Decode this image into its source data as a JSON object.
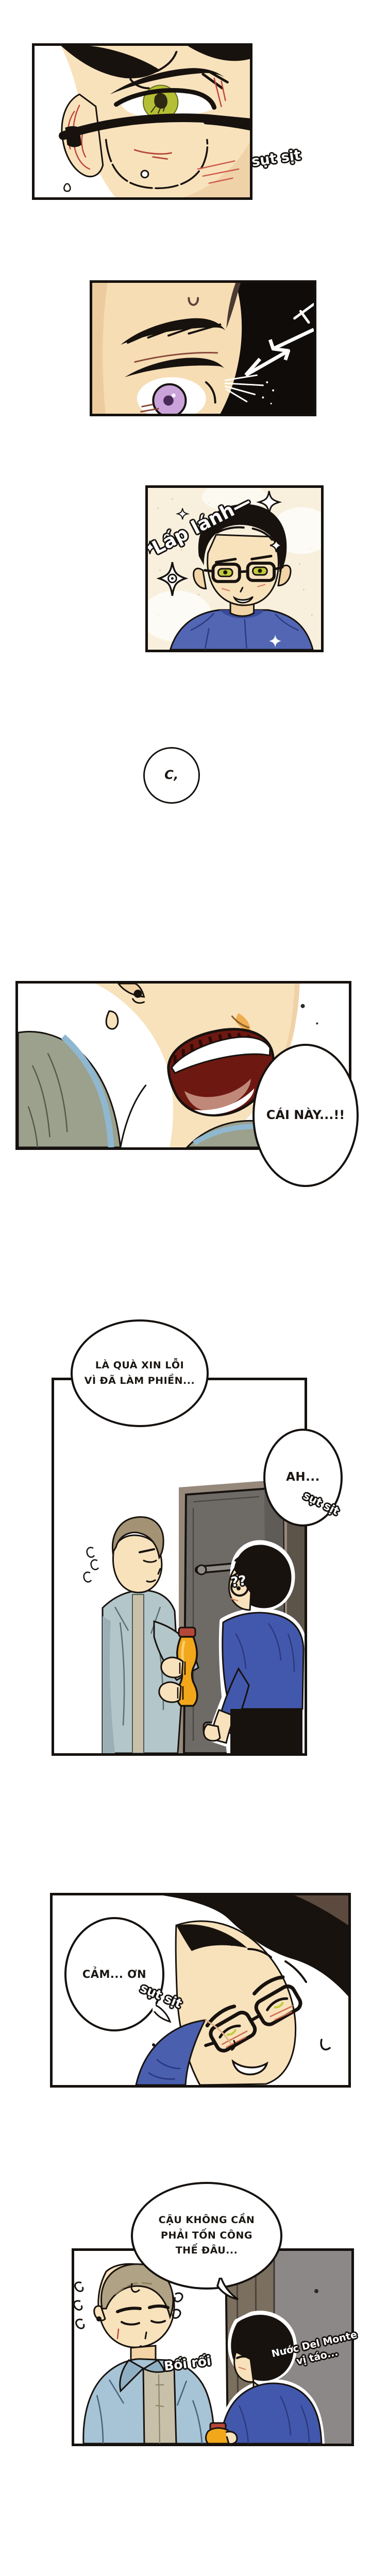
{
  "page_title": "webtoon-episode-page",
  "speech": {
    "whisper_c": "C,",
    "exclaim": "CÁI NÀY...!!",
    "apology_line1": "LÀ QUÀ XIN LỖI",
    "apology_line2": "VÌ ĐÃ LÀM PHIỀN...",
    "ah": "AH...",
    "thanks": "CẢM... ƠN",
    "no_need_line1": "CẬU KHÔNG CẦN",
    "no_need_line2": "PHẢI TỐN CÔNG",
    "no_need_line3": "THẾ ĐÂU..."
  },
  "sfx": {
    "sniffle_1": "sụt sịt",
    "sparkle": "Lấp lánh—",
    "sniffle_2": "sụt sịt",
    "question_marks": "??",
    "sniffle_3": "sụt sịt",
    "flustered": "Bối rối",
    "product_line1": "Nước Del Monte",
    "product_line2": "vị táo..."
  },
  "colors": {
    "panel_border": "#15110e",
    "skin": "#f8e2bc",
    "skin_shade": "#f0d2a8",
    "hair_black": "#17120e",
    "eye_yellow": "#b5bf35",
    "eye_purple": "#c9a3da",
    "cream_background": "#f8f0dd",
    "blue_shirt": "#4a5fae",
    "jacket_green": "#9ba18c",
    "jacket_teal": "#b3c6c9",
    "jacket_denim": "#a7c3d6",
    "door_dark_gray": "#6e6a66",
    "door_light_gray": "#8b8887",
    "bottle_yellow": "#f2a71b",
    "bottle_cap_red": "#b5473a",
    "blush_red": "#c0443c"
  }
}
